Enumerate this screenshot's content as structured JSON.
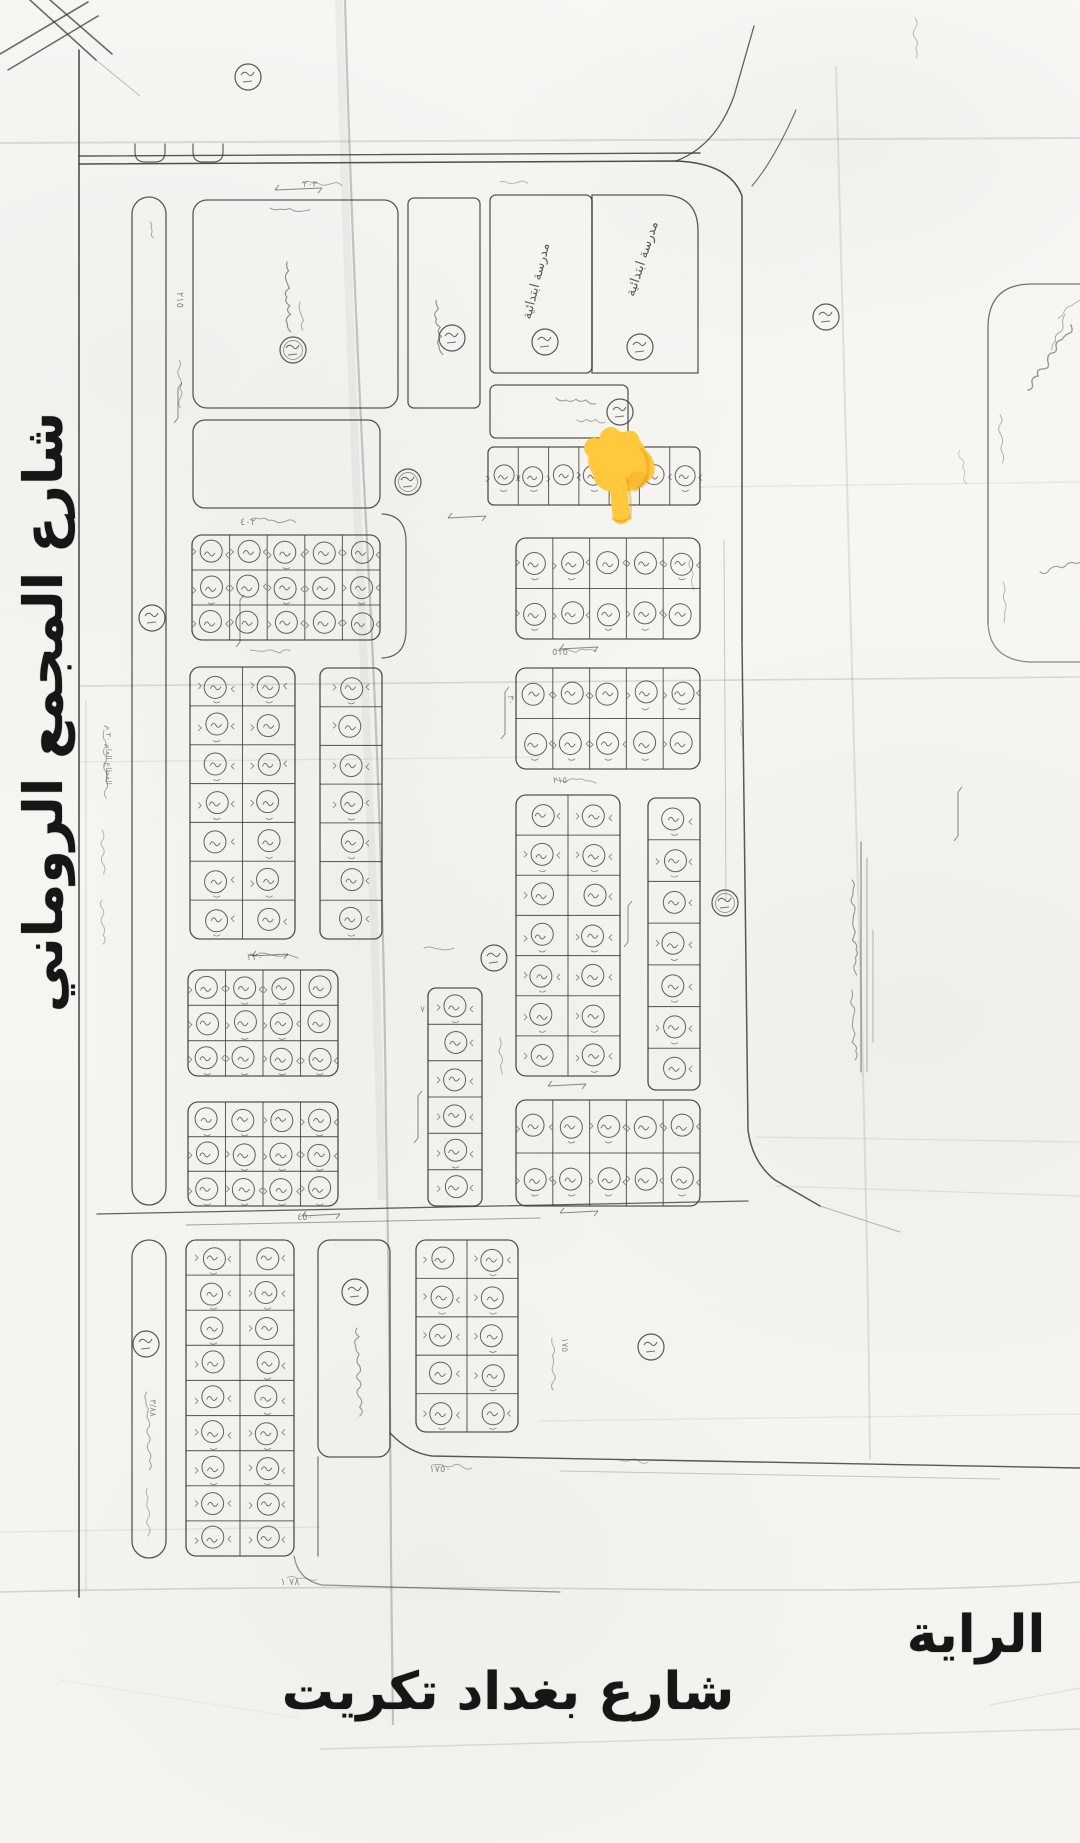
{
  "labels": {
    "street_left": "شارع المجمع الروماني",
    "street_bottom": "شارع بغداد تكريت",
    "area_name": "الراية",
    "school_block": "مدرسة ابتدائية"
  },
  "colors": {
    "paper": "#f8f7f4",
    "ink": "#3d3c3a",
    "ink_faint": "#8a8883",
    "label": "#171614",
    "hand_main": "#FFC83D",
    "hand_shade": "#E8960F",
    "hand_edge": "#D98E12"
  },
  "hand_pointer": {
    "x": 584,
    "y": 416,
    "meaning": "backhand-index-pointing-down"
  },
  "map": {
    "school_label_spots": [
      {
        "x": 540,
        "y": 282,
        "rot": -76
      },
      {
        "x": 646,
        "y": 260,
        "rot": -72
      }
    ],
    "plot_blocks": [
      {
        "x": 488,
        "y": 447,
        "w": 212,
        "h": 58,
        "cols": 7,
        "rows": 1,
        "r": 6
      },
      {
        "x": 192,
        "y": 535,
        "w": 188,
        "h": 105,
        "cols": 5,
        "rows": 3,
        "r": 10
      },
      {
        "x": 190,
        "y": 667,
        "w": 105,
        "h": 272,
        "cols": 2,
        "rows": 7,
        "r": 10
      },
      {
        "x": 320,
        "y": 668,
        "w": 62,
        "h": 271,
        "cols": 1,
        "rows": 7,
        "r": 8
      },
      {
        "x": 188,
        "y": 970,
        "w": 150,
        "h": 106,
        "cols": 4,
        "rows": 3,
        "r": 10
      },
      {
        "x": 188,
        "y": 1102,
        "w": 150,
        "h": 104,
        "cols": 4,
        "rows": 3,
        "r": 10
      },
      {
        "x": 428,
        "y": 988,
        "w": 54,
        "h": 218,
        "cols": 1,
        "rows": 6,
        "r": 8
      },
      {
        "x": 516,
        "y": 538,
        "w": 184,
        "h": 101,
        "cols": 5,
        "rows": 2,
        "r": 10
      },
      {
        "x": 516,
        "y": 668,
        "w": 184,
        "h": 101,
        "cols": 5,
        "rows": 2,
        "r": 10
      },
      {
        "x": 516,
        "y": 795,
        "w": 104,
        "h": 281,
        "cols": 2,
        "rows": 7,
        "r": 10
      },
      {
        "x": 648,
        "y": 798,
        "w": 52,
        "h": 292,
        "cols": 1,
        "rows": 7,
        "r": 8
      },
      {
        "x": 516,
        "y": 1100,
        "w": 184,
        "h": 106,
        "cols": 5,
        "rows": 2,
        "r": 10
      },
      {
        "x": 186,
        "y": 1240,
        "w": 108,
        "h": 316,
        "cols": 2,
        "rows": 9,
        "r": 10
      },
      {
        "x": 416,
        "y": 1240,
        "w": 102,
        "h": 192,
        "cols": 2,
        "rows": 5,
        "r": 10
      }
    ],
    "empty_blocks": [
      {
        "x": 193,
        "y": 200,
        "w": 205,
        "h": 208,
        "r": 14
      },
      {
        "x": 193,
        "y": 420,
        "w": 187,
        "h": 88,
        "r": 12
      },
      {
        "x": 408,
        "y": 198,
        "w": 72,
        "h": 210,
        "r": 6
      },
      {
        "x": 490,
        "y": 195,
        "w": 102,
        "h": 178,
        "r": 6
      },
      {
        "x": 490,
        "y": 385,
        "w": 138,
        "h": 53,
        "r": 6
      },
      {
        "x": 318,
        "y": 1240,
        "w": 72,
        "h": 217,
        "r": 12
      },
      {
        "x": 132,
        "y": 197,
        "w": 34,
        "h": 1008,
        "r": 17
      },
      {
        "x": 132,
        "y": 1240,
        "w": 34,
        "h": 318,
        "r": 17
      }
    ],
    "special_block_paths": [
      {
        "d": "M592 373 L592 195 L662 195 Q698 195 698 231 L698 373 Z",
        "w": 1.3,
        "o": 0.85
      }
    ],
    "road_paths": [
      {
        "d": "M79 50 L79 1597",
        "w": 1.6,
        "o": 0.9
      },
      {
        "d": "M79 156 L700 153",
        "w": 1.4,
        "o": 0.85
      },
      {
        "d": "M79 164 L676 161 Q730 163 742 196 L742 640",
        "w": 1.5,
        "o": 0.9
      },
      {
        "d": "M742 640 L748 1130 Q752 1162 775 1180 L820 1206",
        "w": 1.5,
        "o": 0.85
      },
      {
        "d": "M820 1206 L900 1232",
        "w": 1,
        "o": 0.35
      },
      {
        "d": "M676 161 Q716 146 734 96 L754 26",
        "w": 1.3,
        "o": 0.8
      },
      {
        "d": "M796 110 Q774 160 752 186",
        "w": 1.2,
        "o": 0.7
      },
      {
        "d": "M97 1214 L748 1201",
        "w": 1.3,
        "o": 0.8
      },
      {
        "d": "M186 1225 L540 1218",
        "w": 1,
        "o": 0.45
      },
      {
        "d": "M390 1433 Q409 1453 432 1456 L1080 1468",
        "w": 1.4,
        "o": 0.85
      },
      {
        "d": "M560 1471 L1000 1479",
        "w": 1,
        "o": 0.25
      },
      {
        "d": "M294 1556 Q298 1580 322 1585 L560 1592",
        "w": 1.2,
        "o": 0.55
      },
      {
        "d": "M318 1457 L318 1556",
        "w": 1.2,
        "o": 0.7
      },
      {
        "d": "M135 144 L135 152 Q135 162 145 162 L155 162 Q165 162 165 152 L165 144",
        "w": 1.2,
        "o": 0.8
      },
      {
        "d": "M193 144 L193 152 Q193 162 203 162 L213 162 Q223 162 223 152 L223 144",
        "w": 1.2,
        "o": 0.8
      },
      {
        "d": "M724 540 L726 900",
        "w": 0.9,
        "o": 0.28
      },
      {
        "d": "M86 700 L86 1590",
        "w": 0.8,
        "o": 0.22
      },
      {
        "d": "M382 514 Q406 515 406 542 L406 630 Q406 657 382 658",
        "w": 1.2,
        "o": 0.8
      },
      {
        "d": "M0 54 L88 2",
        "w": 1.6,
        "o": 0.75
      },
      {
        "d": "M8 70 L98 16",
        "w": 1.6,
        "o": 0.75
      },
      {
        "d": "M30 0 L96 60",
        "w": 1.6,
        "o": 0.75
      },
      {
        "d": "M50 0 L112 54",
        "w": 1.6,
        "o": 0.75
      },
      {
        "d": "M96 60 L140 96",
        "w": 1,
        "o": 0.3
      },
      {
        "d": "M988 624 L988 328 Q988 284 1032 284 L1080 284",
        "w": 1.3,
        "o": 0.7
      },
      {
        "d": "M988 624 Q990 660 1030 662 L1080 662",
        "w": 1.2,
        "o": 0.6
      },
      {
        "d": "M861 842 L861 1072",
        "w": 1.2,
        "o": 0.55
      },
      {
        "d": "M867 858 L867 1072",
        "w": 1,
        "o": 0.4
      },
      {
        "d": "M873 930 L873 1042",
        "w": 1,
        "o": 0.35
      }
    ],
    "creases": [
      {
        "d": "M0 143 L1080 138",
        "w": 2,
        "o": 0.16
      },
      {
        "d": "M345 0 Q352 260 368 560 T386 1130 Q390 1330 391 1560 L393 1725",
        "w": 2.2,
        "o": 0.3
      },
      {
        "d": "M339 0 Q348 300 362 620 T382 1200",
        "w": 8,
        "o": 0.06
      },
      {
        "d": "M836 66 Q844 420 856 820 T870 1460",
        "w": 2,
        "o": 0.14
      },
      {
        "d": "M79 686 L1080 677",
        "w": 1.6,
        "o": 0.18
      },
      {
        "d": "M80 762 L540 757",
        "w": 1.2,
        "o": 0.1
      },
      {
        "d": "M700 487 L1080 482",
        "w": 1.2,
        "o": 0.1
      },
      {
        "d": "M756 1137 L1080 1142",
        "w": 1.2,
        "o": 0.12
      },
      {
        "d": "M775 1186 L1080 1196",
        "w": 1.2,
        "o": 0.12
      },
      {
        "d": "M540 1421 L1080 1414",
        "w": 1.2,
        "o": 0.1
      },
      {
        "d": "M0 1532 L320 1527",
        "w": 1.2,
        "o": 0.1
      },
      {
        "d": "M0 1592 Q300 1585 620 1589 T1080 1582",
        "w": 1.6,
        "o": 0.2
      },
      {
        "d": "M320 1749 Q700 1738 1080 1729",
        "w": 1.4,
        "o": 0.16
      },
      {
        "d": "M60 1680 L300 1718",
        "w": 1,
        "o": 0.08
      },
      {
        "d": "M990 1705 L1080 1688",
        "w": 1.2,
        "o": 0.12
      }
    ],
    "circled_numbers": [
      [
        248,
        77
      ],
      [
        293,
        350
      ],
      [
        452,
        338
      ],
      [
        545,
        342
      ],
      [
        640,
        347
      ],
      [
        826,
        317
      ],
      [
        620,
        412
      ],
      [
        152,
        618
      ],
      [
        408,
        482
      ],
      [
        494,
        958
      ],
      [
        725,
        903
      ],
      [
        146,
        1344
      ],
      [
        355,
        1292
      ],
      [
        651,
        1347
      ]
    ],
    "squiggles": [
      [
        270,
        208,
        40,
        4,
        3,
        0.5,
        1,
        1
      ],
      [
        287,
        262,
        70,
        88,
        4,
        0.55,
        1.2,
        2
      ],
      [
        300,
        302,
        28,
        82,
        3,
        0.4,
        1,
        3
      ],
      [
        436,
        300,
        55,
        84,
        4,
        0.55,
        1.1,
        4
      ],
      [
        556,
        398,
        40,
        6,
        3,
        0.5,
        1,
        5
      ],
      [
        577,
        420,
        28,
        2,
        3,
        0.4,
        1,
        6
      ],
      [
        357,
        1328,
        88,
        88,
        4,
        0.5,
        1.1,
        7
      ],
      [
        147,
        1392,
        78,
        88,
        3,
        0.45,
        1,
        8
      ],
      [
        147,
        1488,
        48,
        88,
        3,
        0.35,
        1,
        9
      ],
      [
        104,
        730,
        68,
        88,
        3,
        0.4,
        1,
        10
      ],
      [
        102,
        830,
        44,
        88,
        3,
        0.35,
        1,
        11
      ],
      [
        102,
        900,
        44,
        88,
        3,
        0.35,
        1,
        12
      ],
      [
        179,
        360,
        48,
        88,
        3,
        0.4,
        1,
        13
      ],
      [
        1028,
        390,
        78,
        -55,
        5,
        0.5,
        1.4,
        14
      ],
      [
        1052,
        350,
        38,
        -68,
        3,
        0.4,
        1,
        15
      ],
      [
        1000,
        415,
        48,
        88,
        3,
        0.38,
        1,
        16
      ],
      [
        1040,
        572,
        55,
        -12,
        4,
        0.45,
        1.2,
        17
      ],
      [
        1003,
        582,
        40,
        88,
        3,
        0.35,
        1,
        18
      ],
      [
        1058,
        318,
        28,
        -40,
        3,
        0.35,
        1,
        19
      ],
      [
        852,
        880,
        95,
        88,
        3.5,
        0.5,
        1.1,
        20
      ],
      [
        852,
        990,
        70,
        88,
        3.5,
        0.45,
        1.1,
        21
      ],
      [
        250,
        954,
        48,
        3,
        3,
        0.45,
        1,
        22
      ],
      [
        424,
        948,
        30,
        3,
        3,
        0.4,
        1,
        23
      ],
      [
        250,
        650,
        40,
        3,
        3,
        0.4,
        1,
        24
      ],
      [
        556,
        650,
        40,
        3,
        3,
        0.4,
        1,
        25
      ],
      [
        556,
        780,
        40,
        3,
        3,
        0.4,
        1,
        26
      ],
      [
        250,
        520,
        46,
        3,
        3,
        0.45,
        1,
        27
      ],
      [
        302,
        183,
        40,
        3,
        3,
        0.4,
        1,
        28
      ],
      [
        500,
        182,
        28,
        3,
        3,
        0.35,
        1,
        29
      ],
      [
        552,
        1338,
        52,
        88,
        3,
        0.4,
        1,
        30
      ],
      [
        287,
        1578,
        30,
        3,
        3,
        0.35,
        1,
        31
      ],
      [
        432,
        1465,
        40,
        3,
        3,
        0.4,
        1,
        32
      ],
      [
        620,
        1460,
        28,
        3,
        3,
        0.3,
        1,
        33
      ],
      [
        915,
        18,
        40,
        88,
        3,
        0.3,
        1,
        34
      ],
      [
        960,
        450,
        34,
        80,
        3,
        0.25,
        1,
        35
      ],
      [
        150,
        222,
        16,
        80,
        2,
        0.4,
        1,
        36
      ],
      [
        500,
        1038,
        36,
        88,
        3,
        0.38,
        1,
        37
      ],
      [
        690,
        560,
        30,
        85,
        3,
        0.3,
        1,
        38
      ],
      [
        740,
        720,
        26,
        85,
        3,
        0.25,
        1,
        39
      ]
    ],
    "arrows": [
      [
        275,
        190,
        322,
        188
      ],
      [
        448,
        518,
        486,
        516
      ],
      [
        560,
        649,
        598,
        647
      ],
      [
        252,
        956,
        288,
        954
      ],
      [
        548,
        1086,
        586,
        1084
      ],
      [
        302,
        1216,
        340,
        1214
      ],
      [
        560,
        1213,
        598,
        1211
      ],
      [
        178,
        388,
        178,
        418
      ],
      [
        240,
        600,
        240,
        642
      ],
      [
        418,
        1096,
        418,
        1138
      ],
      [
        628,
        906,
        628,
        942
      ],
      [
        505,
        692,
        505,
        734
      ],
      [
        958,
        792,
        958,
        836
      ]
    ],
    "annotations": [
      {
        "t": "٢١٥",
        "x": 177,
        "y": 300,
        "rot": 90,
        "s": 10
      },
      {
        "t": "٤٠٢",
        "x": 248,
        "y": 525,
        "rot": 0,
        "s": 10
      },
      {
        "t": "٥١٥",
        "x": 560,
        "y": 655,
        "rot": 0,
        "s": 10
      },
      {
        "t": "٣٢٠",
        "x": 255,
        "y": 960,
        "rot": 0,
        "s": 10
      },
      {
        "t": "٢١٥",
        "x": 560,
        "y": 783,
        "rot": 0,
        "s": 9
      },
      {
        "t": "٤٥٠",
        "x": 305,
        "y": 1220,
        "rot": 0,
        "s": 10
      },
      {
        "t": "١٧٥٠",
        "x": 440,
        "y": 1472,
        "rot": 0,
        "s": 10
      },
      {
        "t": "٧٨ ١",
        "x": 290,
        "y": 1585,
        "rot": 0,
        "s": 10
      },
      {
        "t": "١٧٥",
        "x": 562,
        "y": 1345,
        "rot": 90,
        "s": 9
      },
      {
        "t": "٣/٨٨",
        "x": 150,
        "y": 1408,
        "rot": 90,
        "s": 9
      },
      {
        "t": "القطاع العام ٣٠ م",
        "x": 106,
        "y": 755,
        "rot": 90,
        "s": 8
      },
      {
        "t": "٢٠٣",
        "x": 310,
        "y": 187,
        "rot": 0,
        "s": 9
      },
      {
        "t": "٧٠",
        "x": 425,
        "y": 1012,
        "rot": 0,
        "s": 9
      },
      {
        "t": "٣٠",
        "x": 508,
        "y": 700,
        "rot": 90,
        "s": 9
      }
    ]
  }
}
